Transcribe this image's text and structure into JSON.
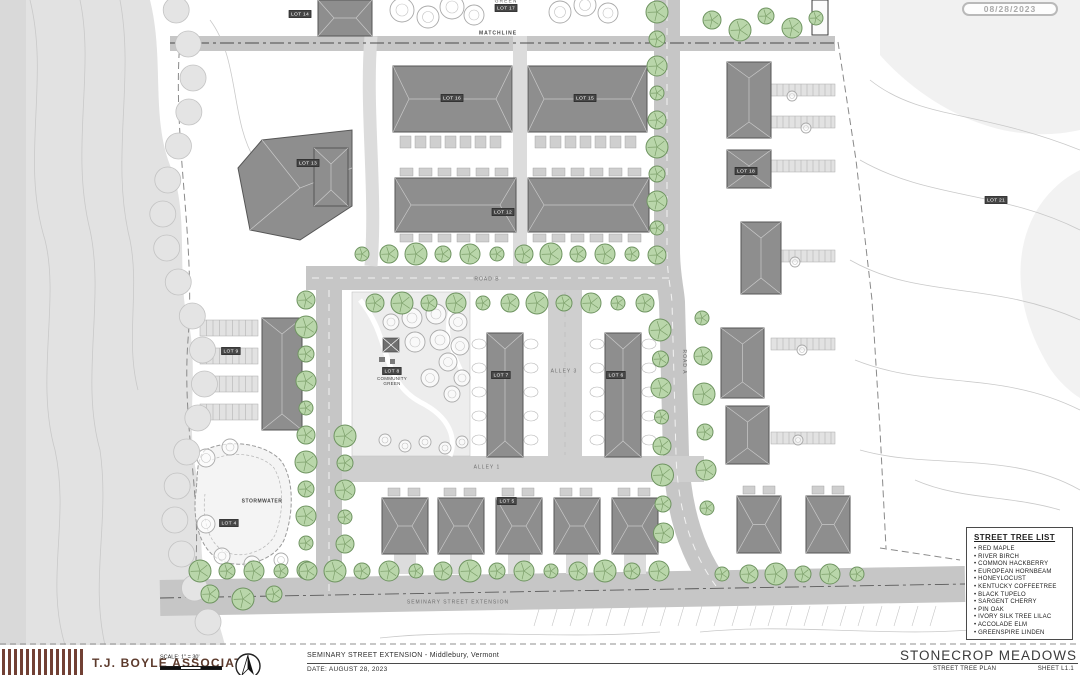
{
  "stamp": {
    "date": "08/28/2023"
  },
  "plan": {
    "road_labels": {
      "matchline": "MATCHLINE",
      "road_a": "ROAD A",
      "road_b": "ROAD B",
      "alley_1": "ALLEY 1",
      "alley_3": "ALLEY 3",
      "seminary_street": "SEMINARY STREET EXTENSION"
    },
    "area_labels": {
      "green": "GREEN",
      "stormwater": "STORMWATER",
      "community_green_line1": "COMMUNITY",
      "community_green_line2": "GREEN"
    },
    "lots": [
      {
        "label": "LOT 14",
        "x": 300,
        "y": 14
      },
      {
        "label": "LOT 17",
        "x": 506,
        "y": 8
      },
      {
        "label": "LOT 16",
        "x": 452,
        "y": 98
      },
      {
        "label": "LOT 15",
        "x": 585,
        "y": 98
      },
      {
        "label": "LOT 13",
        "x": 308,
        "y": 163
      },
      {
        "label": "LOT 12",
        "x": 503,
        "y": 212
      },
      {
        "label": "LOT 18",
        "x": 746,
        "y": 171
      },
      {
        "label": "LOT 21",
        "x": 996,
        "y": 200
      },
      {
        "label": "LOT 9",
        "x": 231,
        "y": 351
      },
      {
        "label": "LOT 8",
        "x": 392,
        "y": 371
      },
      {
        "label": "LOT 7",
        "x": 501,
        "y": 375
      },
      {
        "label": "LOT 6",
        "x": 616,
        "y": 375
      },
      {
        "label": "LOT 5",
        "x": 507,
        "y": 501
      },
      {
        "label": "LOT 4",
        "x": 229,
        "y": 523
      }
    ]
  },
  "tree_list": {
    "title": "STREET TREE LIST",
    "items": [
      "RED MAPLE",
      "RIVER BIRCH",
      "COMMON HACKBERRY",
      "EUROPEAN HORNBEAM",
      "HONEYLOCUST",
      "KENTUCKY COFFEETREE",
      "BLACK TUPELO",
      "SARGENT CHERRY",
      "PIN OAK",
      "IVORY SILK TREE LILAC",
      "ACCOLADE ELM",
      "GREENSPIRE LINDEN"
    ]
  },
  "titleblock": {
    "firm": "T.J. BOYLE ASSOCIATES",
    "scale_label": "SCALE: 1\" = 30'",
    "project_line": "SEMINARY STREET EXTENSION - Middlebury, Vermont",
    "date_line": "DATE: AUGUST 28, 2023",
    "project_name": "STONECROP MEADOWS",
    "sheet_title": "STREET TREE PLAN",
    "sheet_number": "SHEET L1.1"
  }
}
